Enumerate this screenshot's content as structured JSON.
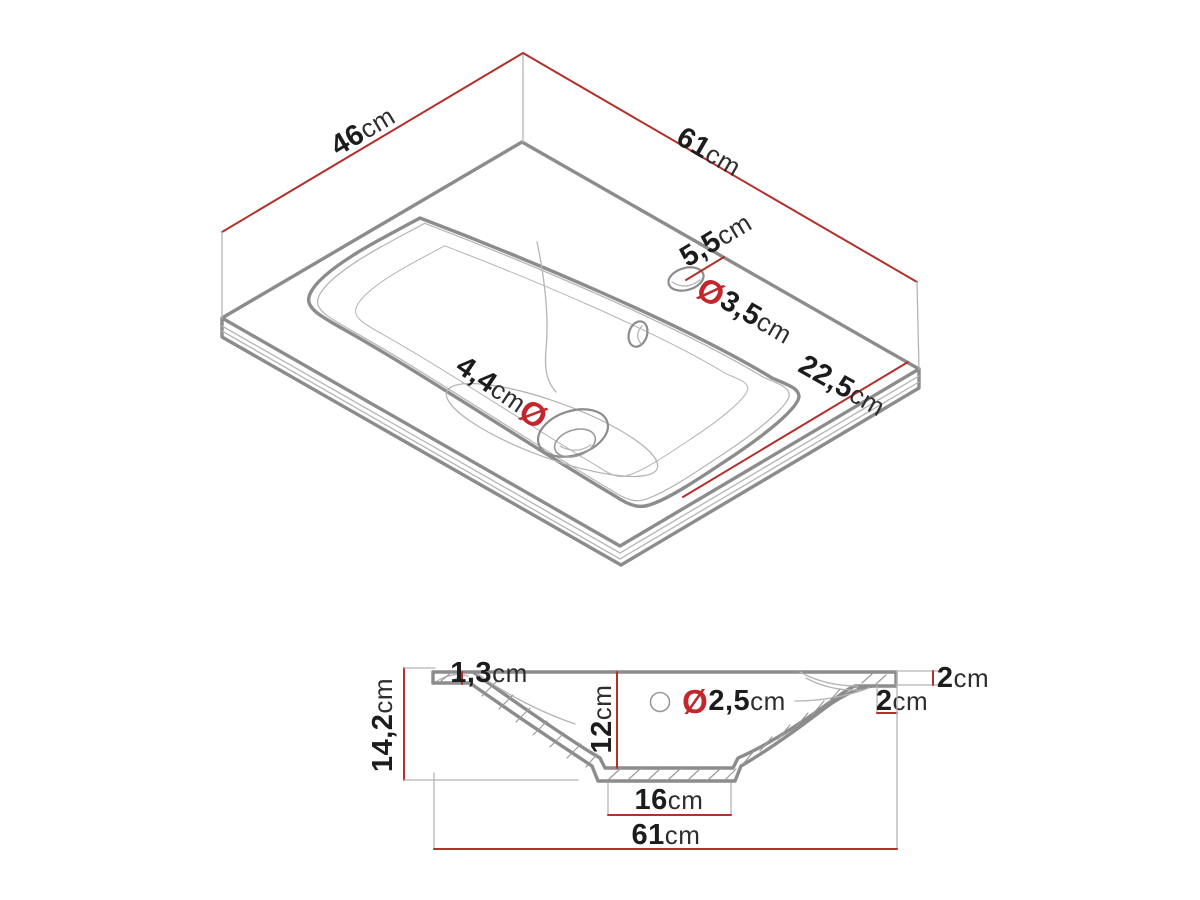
{
  "colors": {
    "background": "#ffffff",
    "outline_gray": "#8c8c8c",
    "thin_gray": "#b5b5b5",
    "hatch_gray": "#9a9a9a",
    "dimension_red": "#b1312b",
    "diameter_red": "#c1272d",
    "text_black": "#1c1c1c"
  },
  "top_view": {
    "dimensions": {
      "depth": {
        "value": "46",
        "unit": "cm"
      },
      "width": {
        "value": "61",
        "unit": "cm"
      },
      "faucet_hole_offset": {
        "value": "5,5",
        "unit": "cm"
      },
      "faucet_hole_diameter": {
        "symbol": "Ø",
        "value": "3,5",
        "unit": "cm"
      },
      "drain_hole_diameter": {
        "value": "4,4",
        "unit": "cm",
        "symbol": "Ø"
      },
      "front_edge_length": {
        "value": "22,5",
        "unit": "cm"
      }
    }
  },
  "section_view": {
    "dimensions": {
      "rim_thickness": {
        "value": "1,3",
        "unit": "cm"
      },
      "total_height": {
        "value": "14,2",
        "unit": "cm"
      },
      "basin_depth": {
        "value": "12",
        "unit": "cm"
      },
      "overflow_hole_diameter": {
        "symbol": "Ø",
        "value": "2,5",
        "unit": "cm"
      },
      "rim_edge_height": {
        "value": "2",
        "unit": "cm"
      },
      "mounting_edge_height": {
        "value": "2",
        "unit": "cm"
      },
      "drain_base_width": {
        "value": "16",
        "unit": "cm"
      },
      "total_width": {
        "value": "61",
        "unit": "cm"
      }
    }
  }
}
